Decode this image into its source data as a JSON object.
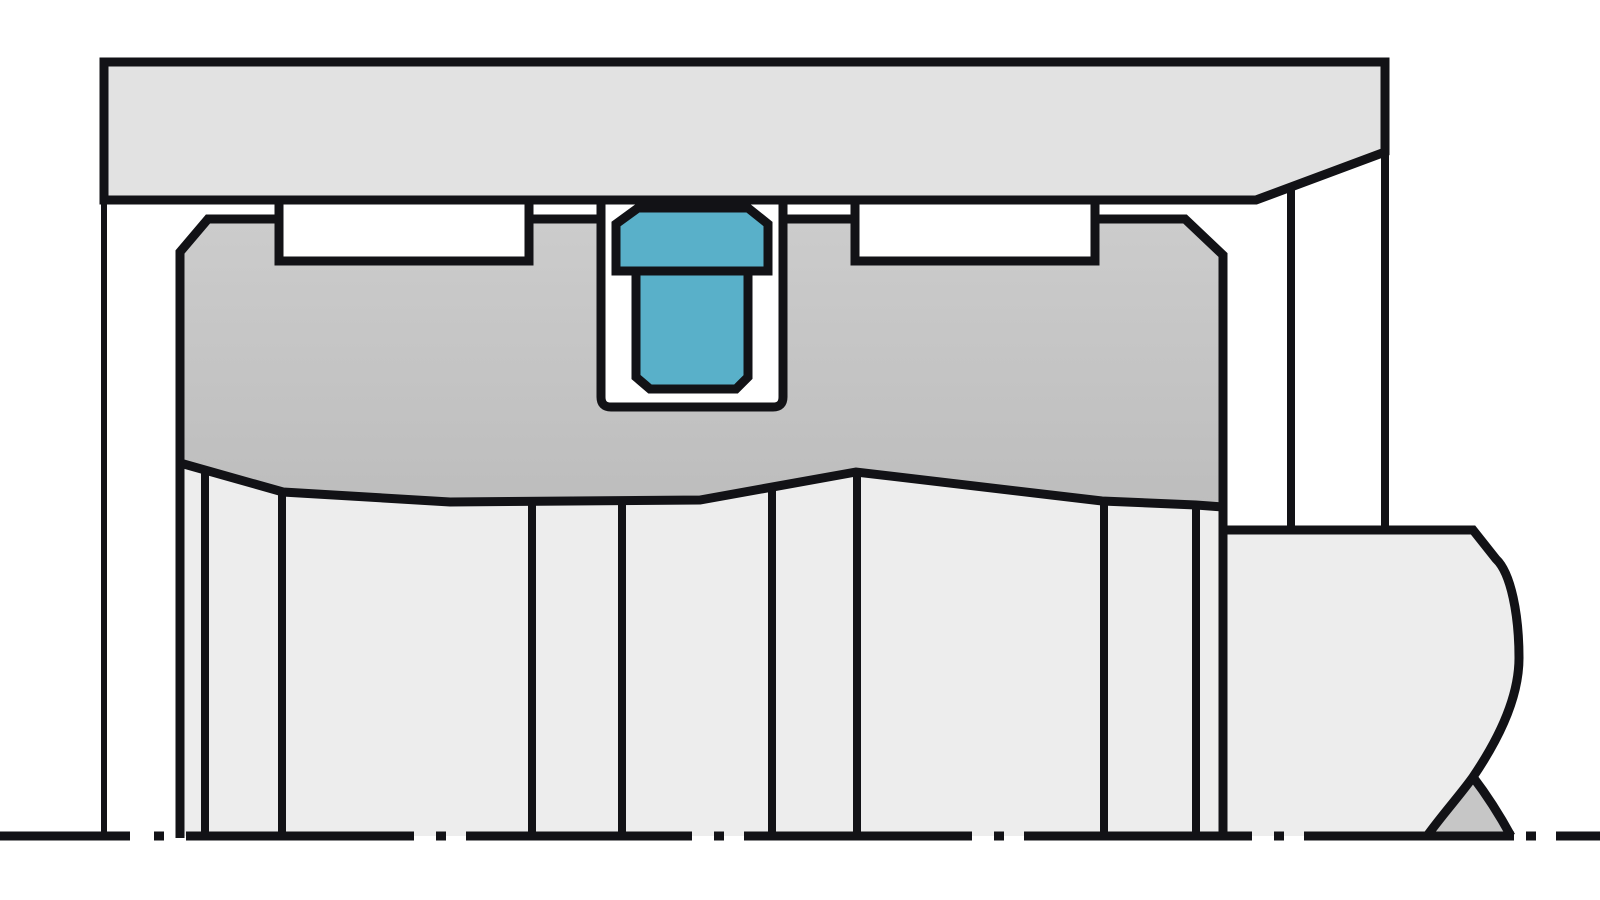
{
  "canvas": {
    "width": 1600,
    "height": 900,
    "background": "#ffffff"
  },
  "colors": {
    "line": "#121216",
    "cylinder": "#e2e2e2",
    "piston": "url(#pistonGrad)",
    "piston_top": "#cccccc",
    "piston_bottom": "#bdbdbd",
    "body": "#ededed",
    "cone": "#c6c6c6",
    "seal": "#59b0c9",
    "background": "#ffffff"
  },
  "diagram": {
    "kind": "technical-cross-section",
    "subject": "piston-seal-in-cylinder-groove",
    "shapes": [
      {
        "name": "piston-lower-body-fill",
        "d": "M 180 463 L 283 492 L 450 502 L 700 500 L 856 472 L 1102 501 L 1196 505 L 1223 507 L 1223 836 L 180 836 Z",
        "fill": "body",
        "stroke": 0
      },
      {
        "name": "rod-fill",
        "d": "M 1223 530 L 1473 530 L 1496 559 C 1511 573 1519 615 1519 658 C 1519 702 1494 746 1473 777 C 1461 794 1442 815 1427 836 L 1223 836 Z",
        "fill": "body",
        "stroke": 0
      },
      {
        "name": "rod-cone-fill",
        "d": "M 1473 777 C 1461 794 1442 815 1427 836 L 1511 836 C 1499 814 1486 794 1473 777 Z",
        "fill": "cone",
        "stroke": 0
      },
      {
        "name": "cylinder-block",
        "d": "M 104 62 L 1385 62 L 1385 152 L 1256 200 L 104 200 Z",
        "fill": "cylinder",
        "stroke": 9
      },
      {
        "name": "cylinder-wall-line",
        "d": "M 104 200 L 104 838",
        "fill": "none",
        "stroke": 6
      },
      {
        "name": "piston-section",
        "d": "M 208 219 L 279 219 L 279 261 L 529 261 L 529 219 L 601 219 L 601 397 Q 601 407 611 407 L 773 407 Q 783 407 783 397 L 783 219 L 855 219 L 855 261 L 1095 261 L 1095 219 L 1185 219 L 1223 255 L 1223 507 L 1196 505 L 1102 501 L 856 472 L 700 500 L 450 502 L 283 492 L 180 463 L 180 252 Z",
        "fill": "piston",
        "stroke": 9
      },
      {
        "name": "piston-left-edge-line",
        "d": "M 180 458 L 180 838",
        "fill": "none",
        "stroke": 9
      },
      {
        "name": "piston-right-edge-line",
        "d": "M 1223 500 L 1223 838",
        "fill": "none",
        "stroke": 9
      },
      {
        "name": "profile-line-1",
        "d": "M 205 470 L 205 838",
        "fill": "none",
        "stroke": 8
      },
      {
        "name": "profile-line-2",
        "d": "M 282 492 L 282 838",
        "fill": "none",
        "stroke": 8
      },
      {
        "name": "profile-line-3",
        "d": "M 532 502 L 532 838",
        "fill": "none",
        "stroke": 8
      },
      {
        "name": "profile-line-4",
        "d": "M 622 501 L 622 838",
        "fill": "none",
        "stroke": 8
      },
      {
        "name": "profile-line-5",
        "d": "M 772 487 L 772 838",
        "fill": "none",
        "stroke": 8
      },
      {
        "name": "profile-line-6",
        "d": "M 857 472 L 857 838",
        "fill": "none",
        "stroke": 8
      },
      {
        "name": "profile-line-7",
        "d": "M 1104 502 L 1104 838",
        "fill": "none",
        "stroke": 8
      },
      {
        "name": "profile-line-8",
        "d": "M 1196 506 L 1196 838",
        "fill": "none",
        "stroke": 8
      },
      {
        "name": "cylinder-right-edge-line",
        "d": "M 1385 148 L 1385 530",
        "fill": "none",
        "stroke": 8
      },
      {
        "name": "bore-edge-line",
        "d": "M 1291 186 L 1291 530",
        "fill": "none",
        "stroke": 8
      },
      {
        "name": "rod-outline",
        "d": "M 1223 530 L 1473 530 L 1496 559 C 1511 573 1519 615 1519 658 C 1519 702 1494 746 1473 777 C 1461 794 1442 815 1427 836",
        "fill": "none",
        "stroke": 9
      },
      {
        "name": "rod-cone-edge",
        "d": "M 1473 777 C 1486 794 1499 814 1511 836",
        "fill": "none",
        "stroke": 9
      },
      {
        "name": "left-groove-side-line-1",
        "d": "M 279 200 L 279 226",
        "fill": "none",
        "stroke": 9
      },
      {
        "name": "left-groove-side-line-2",
        "d": "M 529 200 L 529 226",
        "fill": "none",
        "stroke": 9
      },
      {
        "name": "right-groove-side-line-1",
        "d": "M 855 200 L 855 226",
        "fill": "none",
        "stroke": 9
      },
      {
        "name": "right-groove-side-line-2",
        "d": "M 1095 200 L 1095 226",
        "fill": "none",
        "stroke": 9
      },
      {
        "name": "seal-groove-wall-line-left",
        "d": "M 601 200 L 601 226",
        "fill": "none",
        "stroke": 9
      },
      {
        "name": "seal-groove-wall-line-right",
        "d": "M 783 200 L 783 226",
        "fill": "none",
        "stroke": 9
      },
      {
        "name": "seal-cap",
        "d": "M 616 271 L 616 224 L 638 208 L 748 208 L 768 224 L 768 271 Z",
        "fill": "seal",
        "stroke": 9
      },
      {
        "name": "seal-body",
        "d": "M 636 271 L 748 271 L 748 377 L 736 389 L 650 389 L 636 377 Z",
        "fill": "seal",
        "stroke": 9
      },
      {
        "name": "centerline",
        "d": "M 0 836 L 130 836 M 154 836 L 164 836 M 186 836 L 414 836 M 436 836 L 446 836 M 466 836 L 692 836 M 714 836 L 724 836 M 744 836 L 972 836 M 994 836 L 1004 836 M 1024 836 L 1252 836 M 1274 836 L 1284 836 M 1304 836 L 1514 836 M 1526 836 L 1536 836 M 1556 836 L 1600 836",
        "fill": "none",
        "stroke": 9
      }
    ]
  }
}
